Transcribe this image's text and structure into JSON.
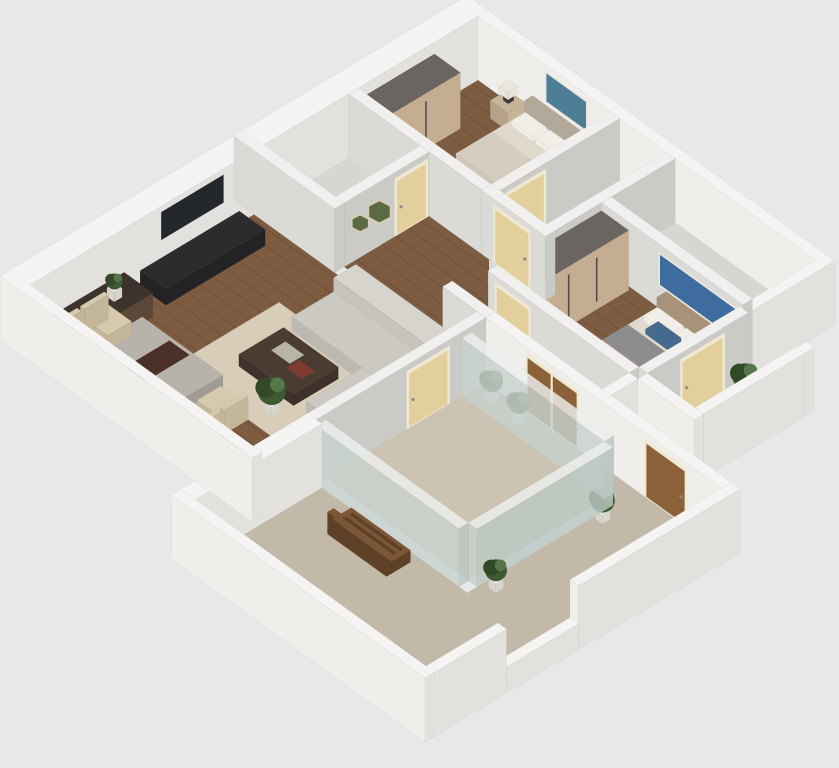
{
  "scene": {
    "type": "3d-floor-plan-render",
    "view": "isometric cutaway from above",
    "description": "Furnished apartment 3D floor plan: two bedrooms, living-dining room, hallway, two small bathrooms, glazed garden room and large wrap-around terrace with bench and plants"
  },
  "colors": {
    "background": "#e8e8e8",
    "woodFloor": "#7d5c41",
    "bathFloor": "#d8d6d2",
    "terraceFloor": "#c2b9a8",
    "room2Floor": "#ccc3b2",
    "wallTopExt": "#f5f4f2",
    "wallFaceSExt": "#efeeeb",
    "wallFaceEExt": "#e2e1dd",
    "wallTopInt": "#f1f0ee",
    "wallFaceSInt": "#dadbd6",
    "wallFaceEInt": "#cacbc6",
    "glassTop": "#eef0ee",
    "glassS": "#c9d3cf",
    "glassE": "#bcc8c4",
    "wardrobeTop": "#6a6560",
    "wardrobeFront": "#c4ad90",
    "wardrobeSide": "#b09a7e",
    "handleDark": "#554f49",
    "headboard1": "#b3a99b",
    "headboard2": "#a8927a",
    "bedTop": "#e0dacd",
    "bedSide": "#cfc8ba",
    "pillow": "#f1eee7",
    "blanketBeige": "#d5cdbf",
    "blanketGray": "#8d8d8f",
    "blanketPink": "#c59d94",
    "cushionBlue": "#46698e",
    "benchWhiteTop": "#efece6",
    "benchWhiteSide": "#e2ded6",
    "nightstand": "#c6b498",
    "nightstandSide": "#b5a288",
    "lampDark": "#3a3a3a",
    "lampShade": "#e9e5db",
    "tv": "#23262a",
    "tvStandTop": "#2c2c2e",
    "tvStandSide": "#232325",
    "sideboardTop": "#3c332c",
    "sideboardSide": "#5c4836",
    "rug": "#d7cdb8",
    "sofaTop": "#d6d4cc",
    "sofaSide": "#c6c4bc",
    "sofaSeatTop": "#cbc9c1",
    "sofaSeatSide": "#bbb9b1",
    "coffeeTop": "#4a3b33",
    "coffeeSide": "#3e322b",
    "bookRed": "#7e3b2e",
    "bookWhite": "#b9b4a8",
    "tableTop": "#b7b3ab",
    "tableSide": "#a09c94",
    "runner": "#4a3029",
    "chair": "#d6c9ae",
    "chairSide": "#c4b698",
    "creamDoor": "#e3cf9c",
    "doorFrame": "#f0e8d2",
    "woodDoor": "#8a6138",
    "woodDoorDark": "#6f4c2c",
    "plantGreen": "#3f5a33",
    "plantDark": "#314927",
    "plantLight": "#55774a",
    "pot": "#e9e7e1",
    "potSide": "#d8d5cd",
    "art1": "#4e7d96",
    "art2": "#3f6c9e",
    "artFrame": "#efe9dc",
    "hexGreen": "#5a6b44",
    "hexFrame": "#d9cdb6",
    "benchWood": "#7c5737",
    "benchWoodSide": "#5f4128",
    "handleMetal": "#8b8b86"
  },
  "rooms": [
    {
      "name": "bedroom-1",
      "floor": "wood",
      "furniture": [
        "wardrobe",
        "double-bed",
        "white-pillows",
        "nightstand-with-lamp",
        "teal-wall-art"
      ]
    },
    {
      "name": "inner-hall",
      "floor": "wood",
      "furniture": [
        "cream-door"
      ]
    },
    {
      "name": "bathroom-1",
      "floor": "tile",
      "furniture": []
    },
    {
      "name": "bedroom-2-master",
      "floor": "wood",
      "furniture": [
        "wardrobe",
        "double-bed-gray-pink-bedding",
        "blue-cushion",
        "white-bench-dresser",
        "blue-abstract-wall-art",
        "balcony-door",
        "potted-plant"
      ]
    },
    {
      "name": "side-balcony",
      "floor": "carpet",
      "furniture": [
        "potted-plant"
      ]
    },
    {
      "name": "bathroom-2",
      "floor": "tile",
      "furniture": []
    },
    {
      "name": "hallway",
      "floor": "wood",
      "furniture": [
        "hexagon-plant-wall-decor",
        "cream-interior-doors"
      ]
    },
    {
      "name": "living-room",
      "floor": "wood",
      "furniture": [
        "wall-tv",
        "tv-stand",
        "dark-wood-sideboard",
        "corner-sofa",
        "coffee-table-with-books",
        "area-rug",
        "dining-table-with-runner",
        "four-dining-chairs",
        "potted-plant"
      ]
    },
    {
      "name": "garden-room",
      "floor": "carpet",
      "furniture": [
        "glass-walls",
        "cream-door"
      ]
    },
    {
      "name": "terrace",
      "floor": "carpet",
      "furniture": [
        "wood-slat-bench",
        "potted-plants",
        "wood-double-door",
        "window-opening"
      ]
    }
  ]
}
